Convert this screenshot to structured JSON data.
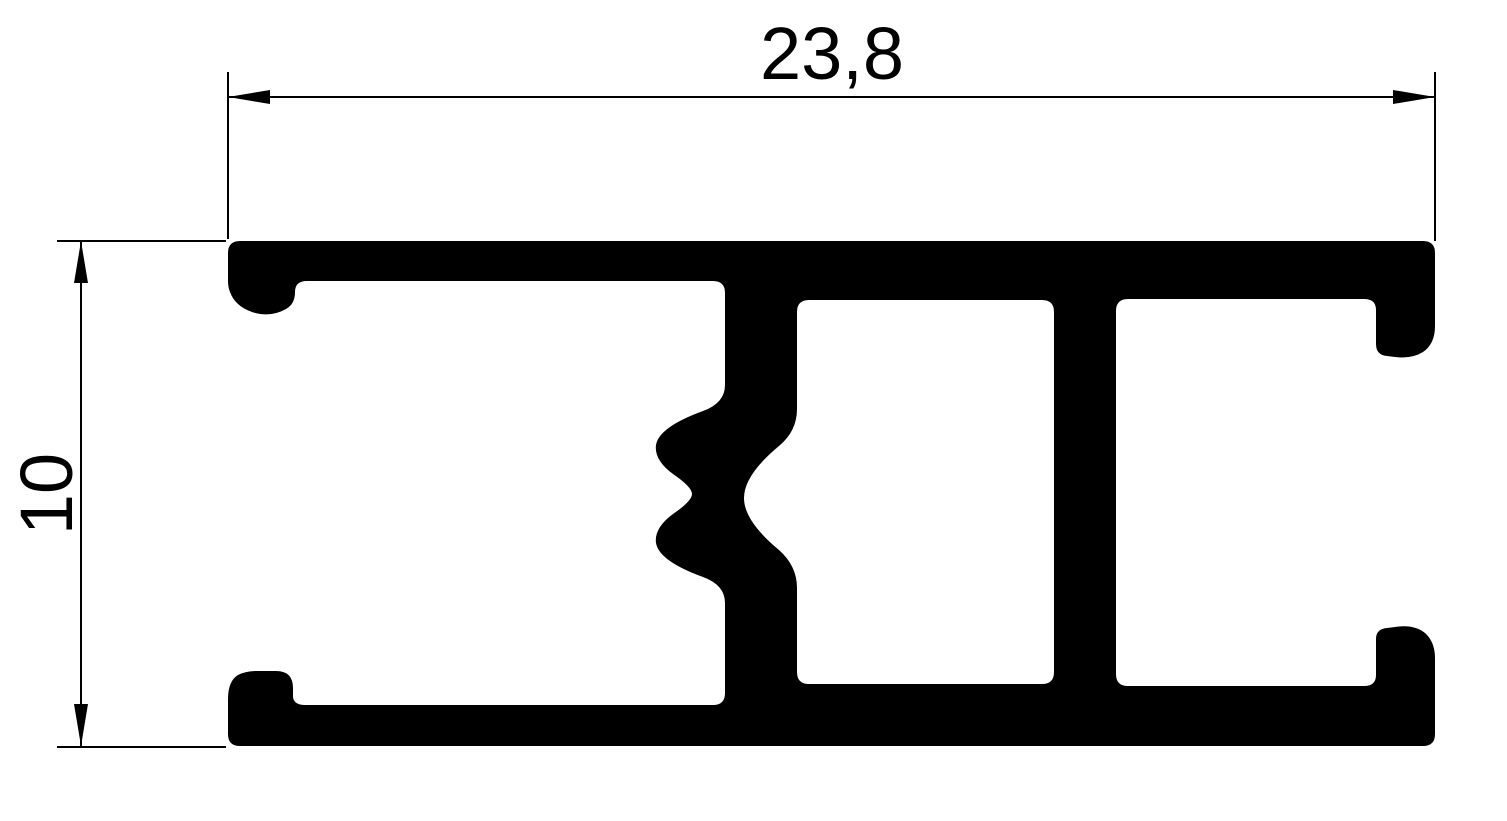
{
  "page": {
    "background": "#ffffff"
  },
  "drawing": {
    "ink": "#000000",
    "width_dimension": {
      "label": "23,8"
    },
    "height_dimension": {
      "label": "10"
    }
  }
}
